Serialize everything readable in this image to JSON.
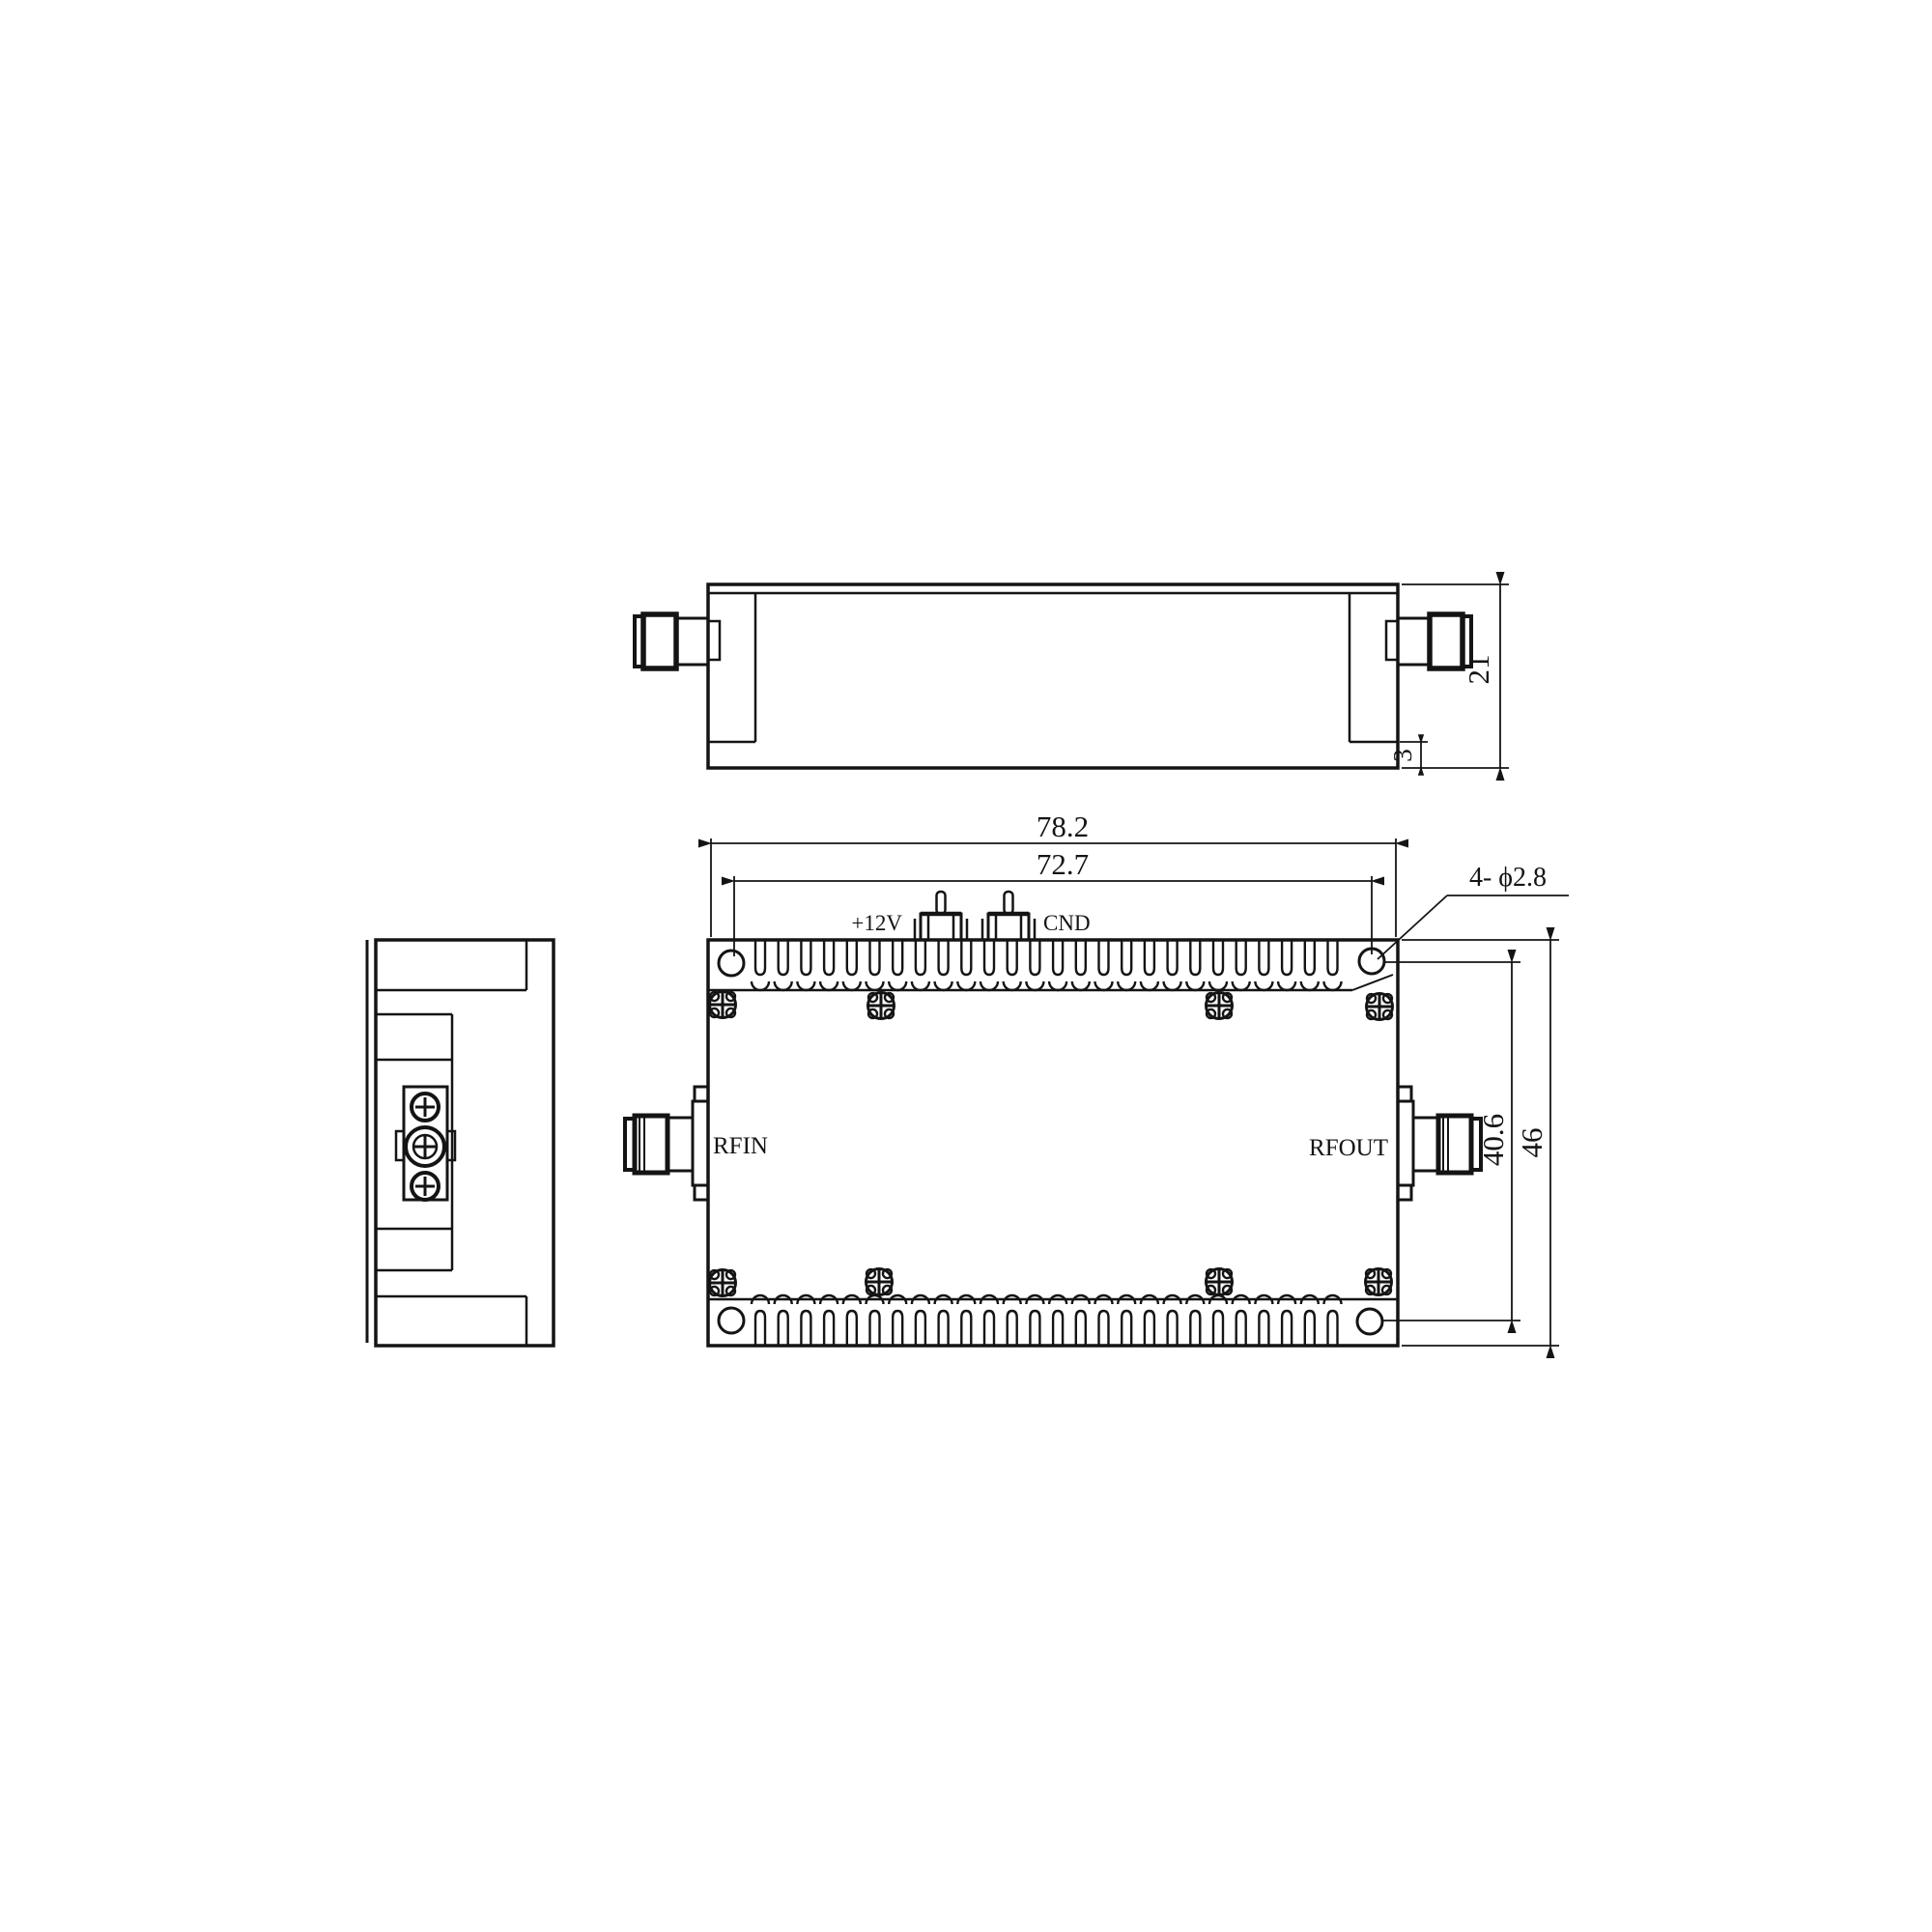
{
  "drawing": {
    "ports": {
      "rf_in": "RFIN",
      "rf_out": "RFOUT"
    },
    "pins": {
      "left_label": "+12V",
      "right_label": "CND"
    },
    "dimensions": {
      "total_length": "78.2",
      "hole_span_length": "72.7",
      "total_width": "46",
      "hole_span_width": "40.6",
      "total_height": "21",
      "base_thickness": "3",
      "hole_callout": "4- ϕ2.8"
    },
    "colors": {
      "line": "#141414",
      "background": "#ffffff"
    }
  }
}
